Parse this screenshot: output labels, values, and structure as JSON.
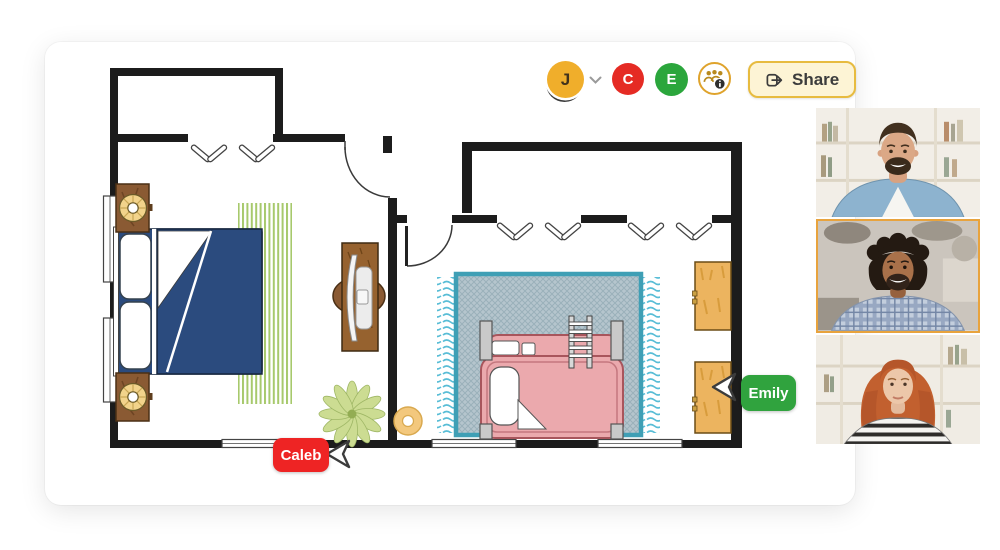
{
  "app": {
    "type": "collaborative-floor-plan-editor"
  },
  "toolbar": {
    "user_avatar": {
      "label": "J",
      "color": "#F0AE2B"
    },
    "collaborator_avatars": [
      {
        "label": "C",
        "color": "#E52B24"
      },
      {
        "label": "E",
        "color": "#2BA63C"
      }
    ],
    "collaborators_button": {
      "icon": "people-info-icon",
      "border_color": "#DFA32C"
    },
    "share_button": {
      "label": "Share",
      "icon": "share-forward-icon",
      "background": "#FDF4D5",
      "border_color": "#E7BB3F"
    }
  },
  "cursors": [
    {
      "name": "Caleb",
      "color": "#EE2424"
    },
    {
      "name": "Emily",
      "color": "#30A33E"
    }
  ],
  "floorplan": {
    "wall_color": "#1C1C1C",
    "rooms": [
      {
        "name": "left-bedroom",
        "furniture": [
          "double-bed-blue",
          "nightstand-with-lamp-top",
          "nightstand-with-lamp-bottom",
          "green-striped-rug",
          "desk-with-chair",
          "potted-plant"
        ]
      },
      {
        "name": "right-bedroom",
        "furniture": [
          "pink-bunk-bed-with-ladder",
          "teal-fringed-rug",
          "wood-dresser-top",
          "wood-dresser-bottom",
          "round-pouf"
        ]
      }
    ],
    "colors": {
      "bed_blue": "#2B4B7E",
      "rug_green_stripe": "#A7C96C",
      "bunk_pink": "#EBA9AD",
      "rug_teal_border": "#3F9FB5",
      "dresser_wood": "#ECB45F",
      "nightstand_wood": "#8A5A33"
    }
  },
  "video_call": {
    "participants": [
      {
        "description": "man with beard in denim shirt, bookshelf background",
        "active": false
      },
      {
        "description": "man with curly dark hair in plaid shirt",
        "active": true
      },
      {
        "description": "woman with red hair in striped top, bookshelf background",
        "active": false
      }
    ],
    "active_border_color": "#E8A33D"
  }
}
